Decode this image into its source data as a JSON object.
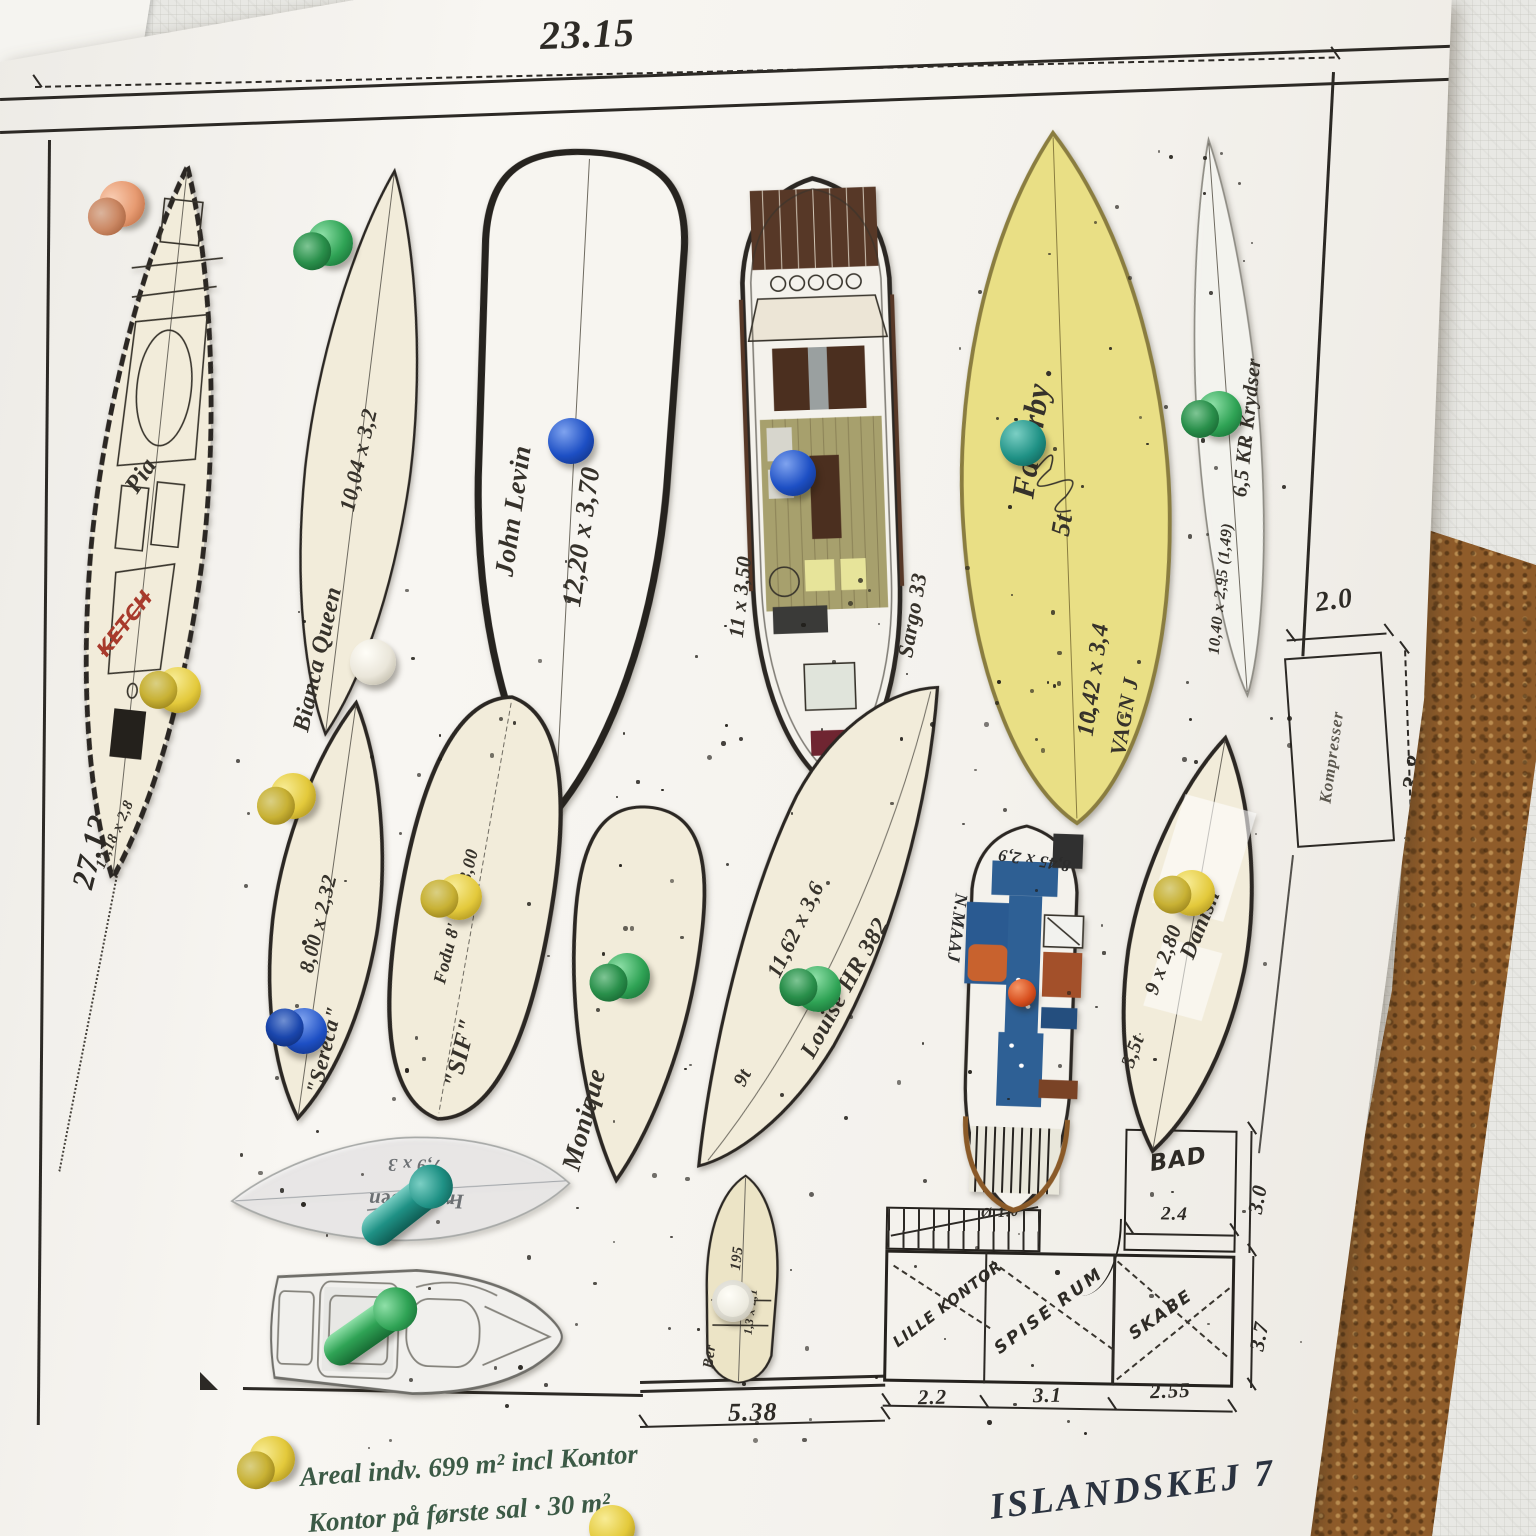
{
  "board": {
    "top_dim": "23.15",
    "side_dim": "3.4",
    "side_label": "til indkørsel",
    "side_total": "27.12",
    "bottom_dim": "5.38",
    "compressor_label": "Kompresser",
    "compressor_w": "2.0",
    "compressor_h": "3.8",
    "note1": "Areal indv. 699 m² incl Kontor",
    "note2": "Kontor på første sal · 30 m²",
    "site": "ISLANDSKEJ 7"
  },
  "floor_plan": {
    "bad": "BAD",
    "bad_w": "2.4",
    "right_top": "3.0",
    "right_bottom": "3.7",
    "stair_dim": "Ø 1.0",
    "room1": "LILLE KONTOR",
    "room2": "SPISE RUM",
    "room3": "SKABE",
    "d1": "2.2",
    "d2": "3.1",
    "d3": "2.55"
  },
  "boats": {
    "pia": {
      "name": "Pia",
      "type_note": "KETCH",
      "dim": "12,18 x 2,8"
    },
    "bianca": {
      "dim": "10,04 x 3,2",
      "name": "Bianca Queen"
    },
    "john": {
      "dim": "12,20 x 3,70",
      "name": "John Levin"
    },
    "sargo": {
      "dim": "11 x 3,50",
      "name": "Sargo 33"
    },
    "fauerby": {
      "name": "Fauerby .",
      "weight": "5t",
      "dim": "10,42 x 3,4",
      "owner": "VAGN J"
    },
    "kr65": {
      "name": "6,5 KR Krydser",
      "dim": "10,40 x 2,95 (1,49)"
    },
    "sereca": {
      "dim": "8,00 x 2,32",
      "name": "\"Sereca\""
    },
    "sif": {
      "dim": "Fodu 8' Tc x 3,00",
      "name": "\"SIF\""
    },
    "monique": {
      "name": "Monique"
    },
    "louise": {
      "dim": "11,62 x 3,6",
      "name": "Louise HR 382",
      "weight": "9t"
    },
    "nmaaj": {
      "dim": "8,45 x 2,9",
      "name": "N.MAAJ"
    },
    "danish": {
      "name": "Danish",
      "dim": "9 x 2,80",
      "weight": "3,5t"
    },
    "irolo": {
      "name": "Irolo Joen",
      "dim": "7,9 x 3"
    },
    "ber": {
      "name": "Ber",
      "dim1": "195",
      "dim2": "1,3 x 2,1"
    }
  },
  "pins": [
    {
      "x": 122,
      "y": 204,
      "color": "orange",
      "type": "double",
      "rot": -25
    },
    {
      "x": 178,
      "y": 690,
      "color": "yellow",
      "type": "double",
      "rot": 15
    },
    {
      "x": 330,
      "y": 243,
      "color": "green",
      "type": "double",
      "rot": -10
    },
    {
      "x": 373,
      "y": 662,
      "color": "white",
      "type": "ball",
      "rot": 0
    },
    {
      "x": 571,
      "y": 441,
      "color": "blue",
      "type": "ball",
      "rot": 0
    },
    {
      "x": 793,
      "y": 473,
      "color": "blue",
      "type": "ball",
      "rot": 0
    },
    {
      "x": 1023,
      "y": 443,
      "color": "teal",
      "type": "ball",
      "rot": 0
    },
    {
      "x": 1219,
      "y": 414,
      "color": "green",
      "type": "double",
      "rot": 0
    },
    {
      "x": 293,
      "y": 796,
      "color": "yellow",
      "type": "double",
      "rot": -15
    },
    {
      "x": 304,
      "y": 1031,
      "color": "blue",
      "type": "double",
      "rot": 25
    },
    {
      "x": 459,
      "y": 897,
      "color": "yellow",
      "type": "double",
      "rot": 10
    },
    {
      "x": 627,
      "y": 976,
      "color": "green",
      "type": "double",
      "rot": -5
    },
    {
      "x": 818,
      "y": 989,
      "color": "green",
      "type": "double",
      "rot": 20
    },
    {
      "x": 1022,
      "y": 993,
      "color": "red",
      "type": "ball",
      "small": true,
      "rot": 0
    },
    {
      "x": 1192,
      "y": 893,
      "color": "yellow",
      "type": "double",
      "rot": 10
    },
    {
      "x": 400,
      "y": 1212,
      "color": "teal",
      "type": "side",
      "rot": -38
    },
    {
      "x": 363,
      "y": 1333,
      "color": "green",
      "type": "side",
      "rot": -35
    },
    {
      "x": 733,
      "y": 1301,
      "color": "white",
      "type": "flat",
      "rot": 0
    },
    {
      "x": 272,
      "y": 1459,
      "color": "yellow",
      "type": "double",
      "rot": -20
    },
    {
      "x": 612,
      "y": 1528,
      "color": "yellow",
      "type": "ball",
      "rot": 0
    }
  ]
}
